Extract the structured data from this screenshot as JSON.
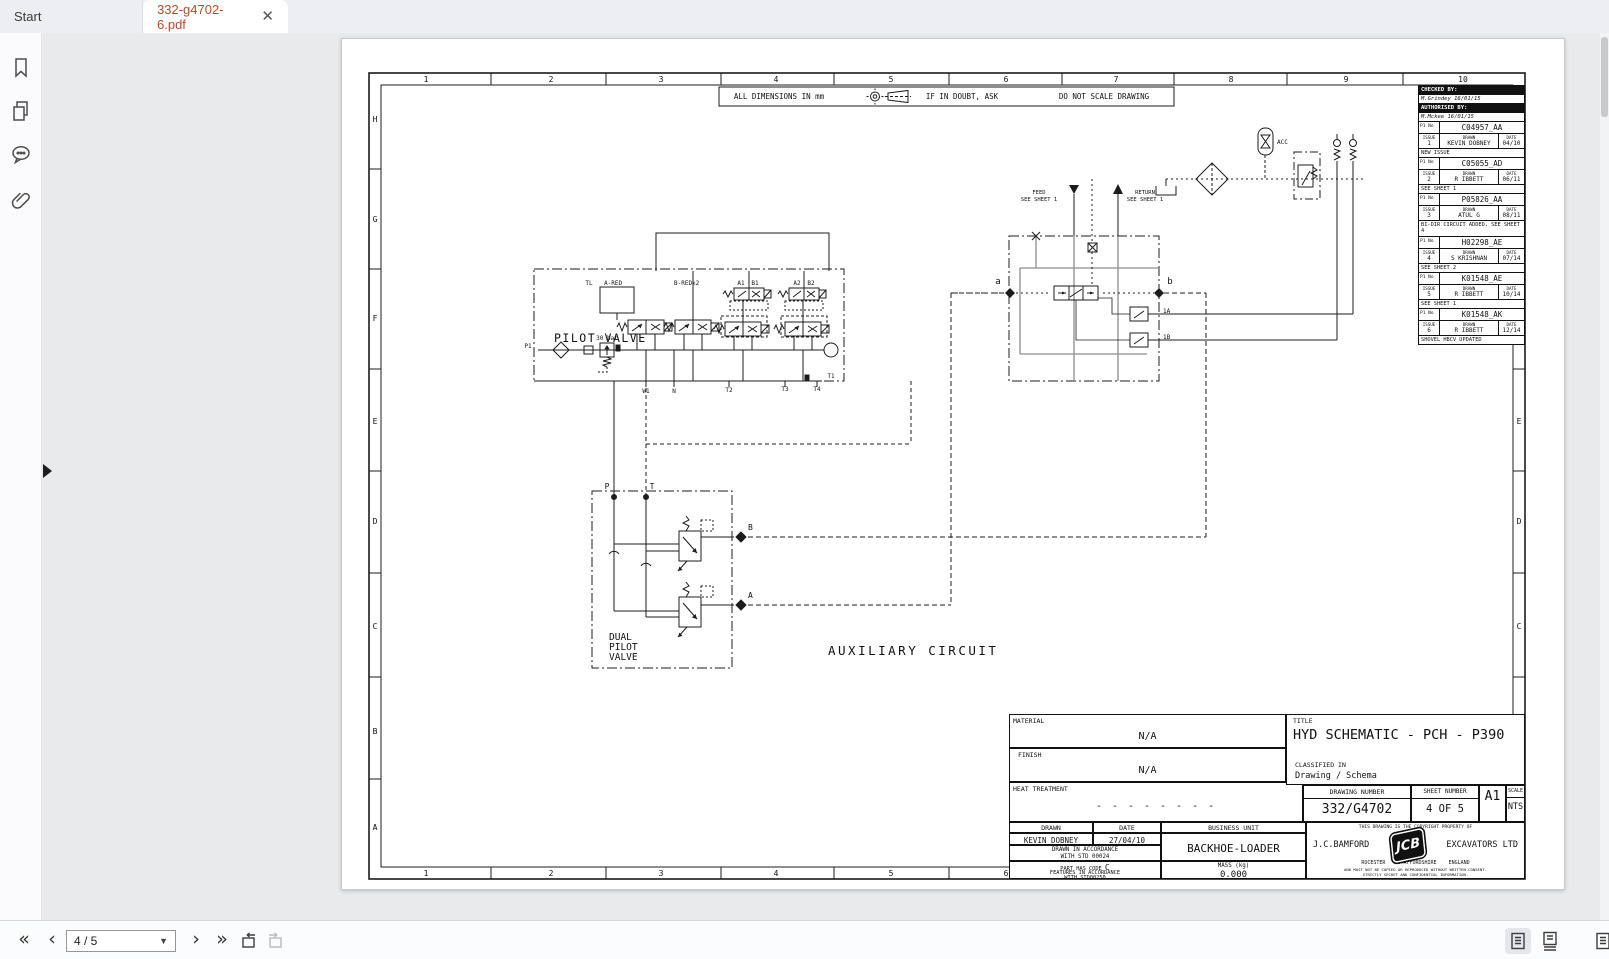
{
  "tab_bar": {
    "start_tab": "Start",
    "document_tab": "332-g4702-6.pdf"
  },
  "sidebar": {
    "icons": [
      "bookmarks",
      "pages",
      "comments",
      "attachments"
    ]
  },
  "status_bar": {
    "page_indicator": "4 / 5"
  },
  "colors": {
    "active_tab_text": "#c2452a",
    "drawing_line": "#1c1c1c",
    "gray_line": "#8d8d8d"
  },
  "drawing": {
    "grid": {
      "columns": [
        "1",
        "2",
        "3",
        "4",
        "5",
        "6",
        "7",
        "8",
        "9",
        "10"
      ],
      "rows": [
        "H",
        "G",
        "F",
        "E",
        "D",
        "C",
        "B",
        "A"
      ]
    },
    "notes": {
      "dimensions": "ALL DIMENSIONS IN mm",
      "doubt": "IF IN DOUBT, ASK",
      "no_scale": "DO NOT SCALE DRAWING"
    },
    "schematic": {
      "pilot_valve": "PILOT VALVE",
      "dual_pilot_valve_1": "DUAL",
      "dual_pilot_valve_2": "PILOT",
      "dual_pilot_valve_3": "VALVE",
      "auxiliary_circuit": "AUXILIARY CIRCUIT",
      "tl": "TL",
      "a_red": "A-RED",
      "b_red": "B-REDx2",
      "a1": "A1",
      "b1": "B1",
      "a2": "A2",
      "b2": "B2",
      "bar_30": "30 bar",
      "p1": "P1",
      "w1": "W1",
      "n": "N",
      "t1": "T1",
      "t2": "T2",
      "t3": "T3",
      "t4": "T4",
      "p": "P",
      "t": "T",
      "out_b": "B",
      "out_a": "A",
      "port_a": "a",
      "port_b": "b",
      "v_1a": "1A",
      "v_1b": "1B",
      "feed": "FEED",
      "feed_sheet": "SEE SHEET 1",
      "ret": "RETURN",
      "ret_sheet": "SEE SHEET 1",
      "acc": "ACC"
    },
    "revision_table": {
      "checked_by_label": "CHECKED BY:",
      "checked_by": "M.Grindey 16/01/15",
      "authorised_by_label": "AUTHORISED BY:",
      "authorised_by": "M.Mckee 16/01/15",
      "p1_no_label": "P1 No",
      "issue_label": "ISSUE",
      "drawn_label": "DRAWN",
      "date_label": "DATE",
      "entries": [
        {
          "p1_no": "C04957_AA",
          "issue": "1",
          "drawn": "KEVIN DOBNEY",
          "date": "04/10",
          "note": "NEW ISSUE"
        },
        {
          "p1_no": "C05055_AD",
          "issue": "2",
          "drawn": "R IBBETT",
          "date": "06/11",
          "note": "SEE SHEET 1"
        },
        {
          "p1_no": "P05826_AA",
          "issue": "3",
          "drawn": "ATUL G",
          "date": "08/11",
          "note": "BI-DIR CIRCUIT ADDED, SEE SHEET 4"
        },
        {
          "p1_no": "H02298_AE",
          "issue": "4",
          "drawn": "S KRISHNAN",
          "date": "07/14",
          "note": "SEE SHEET 2"
        },
        {
          "p1_no": "K01548_AE",
          "issue": "5",
          "drawn": "R IBBETT",
          "date": "10/14",
          "note": "SEE SHEET 1"
        },
        {
          "p1_no": "K01548_AK",
          "issue": "6",
          "drawn": "R IBBETT",
          "date": "12/14",
          "note": "SHOVEL HBCV UPDATED"
        }
      ]
    },
    "title_block": {
      "material_label": "MATERIAL",
      "material": "N/A",
      "finish_label": "FINISH",
      "finish": "N/A",
      "heat_label": "HEAT TREATMENT",
      "heat": "- - - - - - - -",
      "title_label": "TITLE",
      "title": "HYD SCHEMATIC - PCH - P390",
      "classified_label": "CLASSIFIED IN",
      "classified": "Drawing / Schema",
      "drawing_number_label": "DRAWING NUMBER",
      "drawing_number": "332/G4702",
      "sheet_number_label": "SHEET NUMBER",
      "sheet_number": "4 OF 5",
      "size": "A1",
      "scale_label": "SCALE",
      "scale": "NTS",
      "drawn_label": "DRAWN",
      "drawn": "KEVIN DOBNEY",
      "date_label": "DATE",
      "date": "27/04/10",
      "business_unit_label": "BUSINESS UNIT",
      "business_unit": "BACKHOE-LOADER",
      "accordance_1": "DRAWN IN ACCORDANCE",
      "accordance_2": "WITH STD 00024",
      "code_1": "PART HAS CODE",
      "code_letter": "C",
      "code_2": "FEATURES IN ACCORDANCE",
      "code_3": "WITH STD00250",
      "mass_label": "MASS (kg)",
      "mass": "0.000",
      "copyright": "THIS DRAWING IS THE COPYRIGHT PROPERTY OF",
      "company_left": "J.C.BAMFORD",
      "logo": "JCB",
      "company_right": "EXCAVATORS LTD",
      "address": "ROCESTER    STAFFORDSHIRE    ENGLAND",
      "legal_1": "AND MUST NOT BE COPIED OR REPRODUCED WITHOUT WRITTEN CONSENT.",
      "legal_2": "STRICTLY SECRET AND CONFIDENTIAL INFORMATION."
    }
  }
}
